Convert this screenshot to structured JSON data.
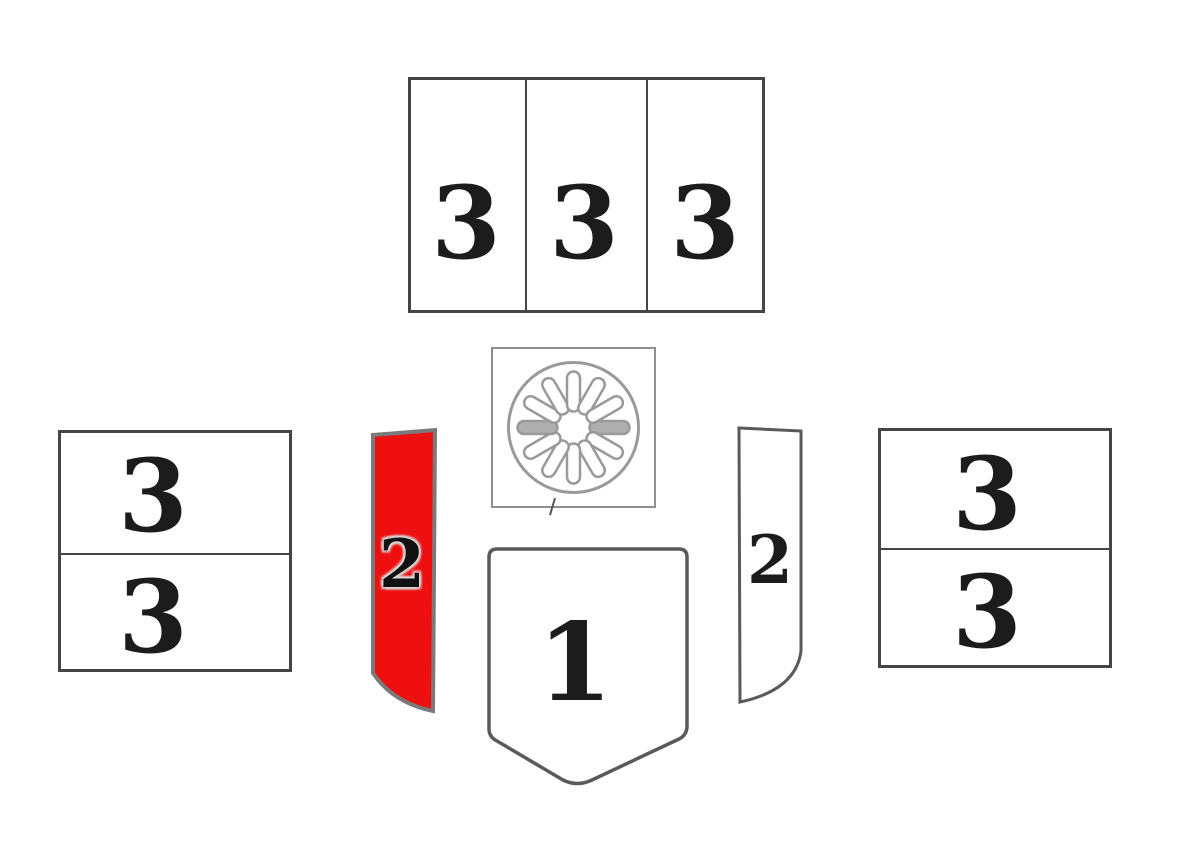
{
  "diagram": {
    "type": "stove-firebrick-parts-layout",
    "colors": {
      "highlight": "#ee1010",
      "outline_dark": "#454545",
      "outline_light": "#9a9a9a",
      "label": "#1c1c1c",
      "background": "#ffffff"
    },
    "parts": {
      "top_row_panels": {
        "labels": [
          "3",
          "3",
          "3"
        ]
      },
      "left_stack_panels": {
        "labels": [
          "3",
          "3"
        ]
      },
      "right_stack_panels": {
        "labels": [
          "3",
          "3"
        ]
      },
      "left_strip": {
        "label": "2",
        "highlighted": true
      },
      "right_strip": {
        "label": "2",
        "highlighted": false
      },
      "base_shield": {
        "label": "1"
      },
      "round_grate": {
        "slots": 12
      }
    }
  }
}
